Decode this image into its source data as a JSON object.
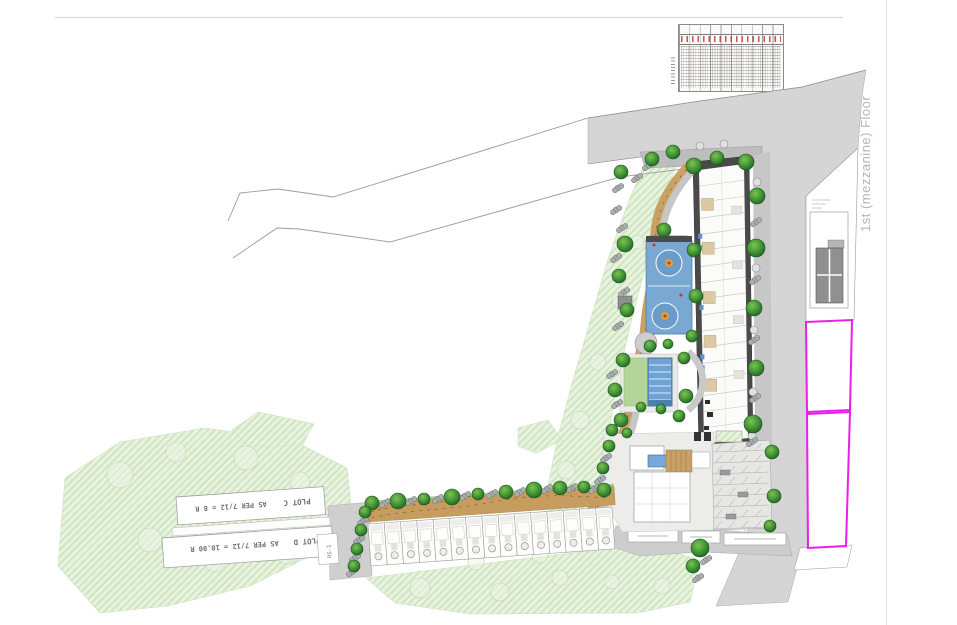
{
  "drawing": {
    "floor_label": "1st (mezzanine) Floor",
    "plot_c": {
      "name": "PLOT C",
      "note": "AS PER 7/12 = 8 R"
    },
    "plot_d": {
      "name": "PLOT D",
      "note": "AS PER 7/12 = 10.00 R"
    },
    "survey_label": "RS-1"
  },
  "colors": {
    "road_gray": "#d5d5d5",
    "plot_boundary_magenta": "#ea1fea",
    "pool_blue": "#6fa3d6",
    "court_blue": "#79a9d2",
    "lawn_green": "#b5d49a",
    "tree_green": "#2e7d32",
    "path_tan": "#c69d5e",
    "vegetation_hatch": "#e9f3e1"
  }
}
